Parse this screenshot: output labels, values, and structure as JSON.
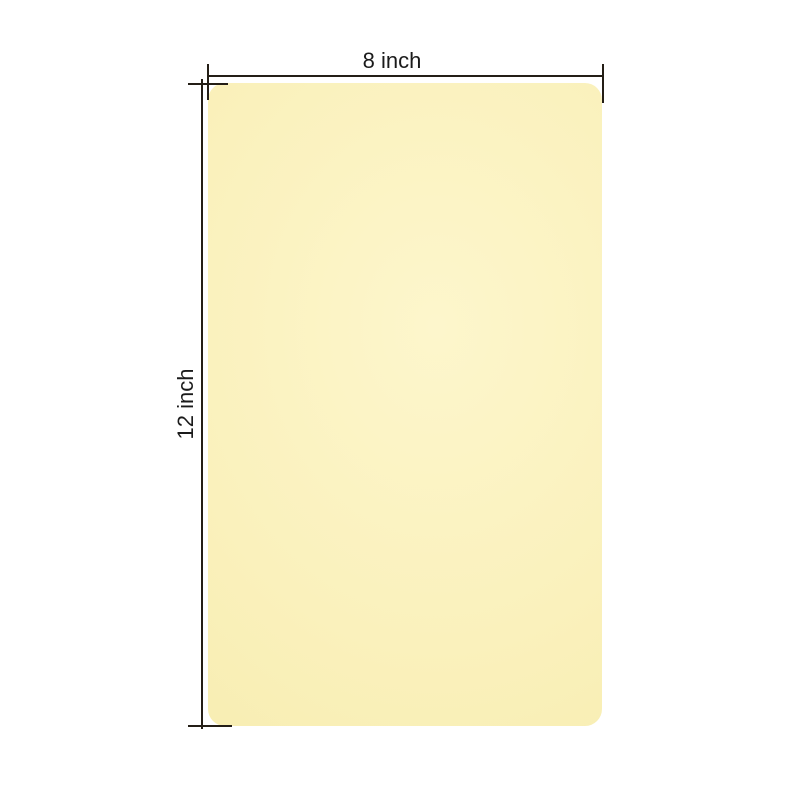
{
  "image": {
    "background_color": "#ffffff",
    "pad": {
      "description": "blank pale-yellow rounded rectangular pad",
      "fill_color": "#faf1bc",
      "fill_highlight_color": "#fdf6cc",
      "fill_edge_color": "#f7ecae"
    },
    "annotations": {
      "line_color": "#241e16",
      "width_dimension": {
        "label": "8 inch"
      },
      "height_dimension": {
        "label": "12 inch"
      }
    }
  }
}
